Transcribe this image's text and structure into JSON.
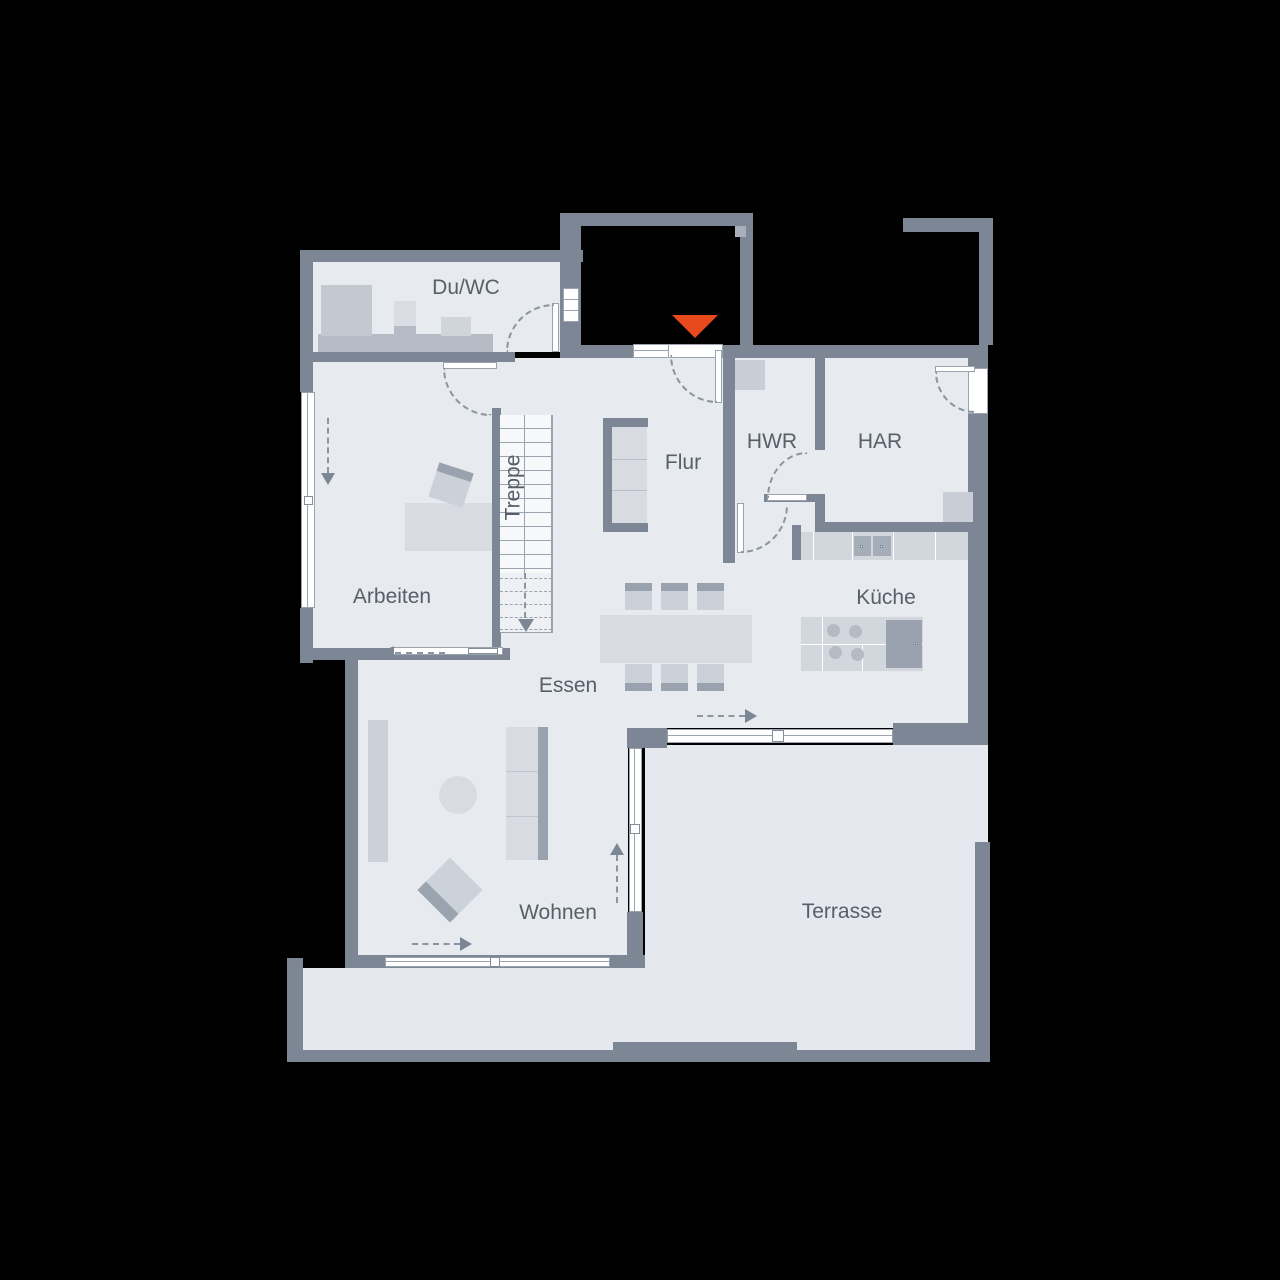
{
  "plan": {
    "rooms": [
      {
        "id": "duwc",
        "label": "Du/WC"
      },
      {
        "id": "flur",
        "label": "Flur"
      },
      {
        "id": "hwr",
        "label": "HWR"
      },
      {
        "id": "har",
        "label": "HAR"
      },
      {
        "id": "treppe",
        "label": "Treppe"
      },
      {
        "id": "arbeiten",
        "label": "Arbeiten"
      },
      {
        "id": "kueche",
        "label": "Küche"
      },
      {
        "id": "essen",
        "label": "Essen"
      },
      {
        "id": "wohnen",
        "label": "Wohnen"
      },
      {
        "id": "terrasse",
        "label": "Terrasse"
      }
    ],
    "entrance_marker": {
      "shape": "triangle-down",
      "color": "#e84a1e"
    },
    "colors": {
      "background": "#000000",
      "floor": "#e7eaef",
      "wall": "#7c8694",
      "accent": "#e84a1e"
    }
  }
}
